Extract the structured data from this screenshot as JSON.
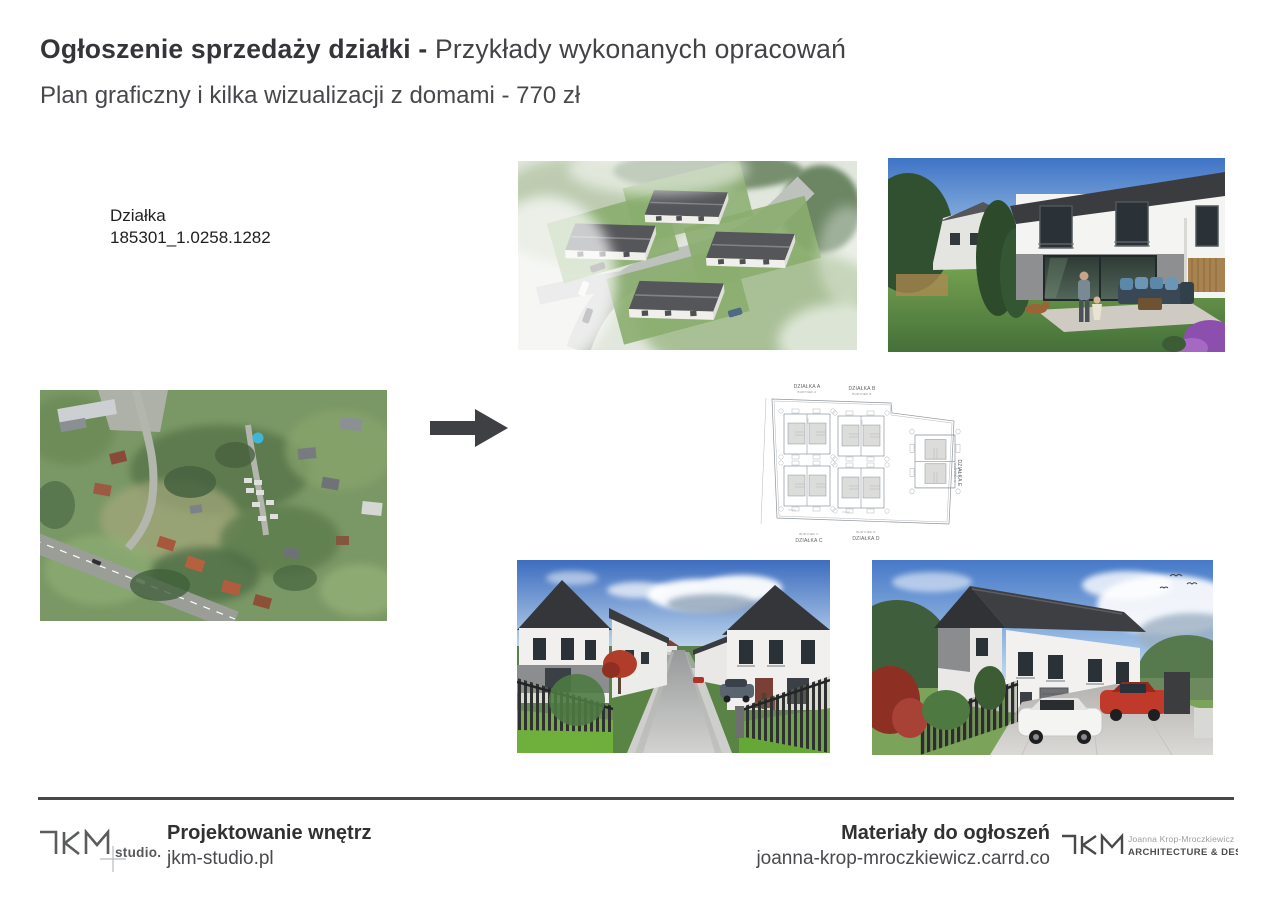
{
  "header": {
    "title_bold": "Ogłoszenie sprzedaży działki -",
    "title_regular": " Przykłady wykonanych opracowań",
    "subtitle": "Plan graficzny i kilka wizualizacji z domami - 770 zł"
  },
  "plot_info": {
    "label": "Działka",
    "id": "185301_1.0258.1282"
  },
  "site_plan": {
    "plots": [
      {
        "name": "DZIAŁKA A",
        "building": "BUDYNEK A"
      },
      {
        "name": "DZIAŁKA B",
        "building": "BUDYNEK B"
      },
      {
        "name": "DZIAŁKA C",
        "building": "BUDYNEK C"
      },
      {
        "name": "DZIAŁKA D",
        "building": "BUDYNEK D"
      },
      {
        "name": "DZIAŁKA E",
        "building": "BUDYNEK E"
      }
    ]
  },
  "footer": {
    "left": {
      "logo_studio": "studio.pl",
      "title": "Projektowanie wnętrz",
      "url": "jkm-studio.pl"
    },
    "right": {
      "title": "Materiały do ogłoszeń",
      "url": "joanna-krop-mroczkiewicz.carrd.co",
      "logo_name": "Joanna Krop-Mroczkiewicz",
      "logo_tagline": "ARCHITECTURE & DESIGN"
    }
  },
  "colors": {
    "text_dark": "#353539",
    "text_gray": "#48484c",
    "arrow": "#3f4043",
    "divider": "#47484a",
    "roof_dark": "#3d3e42",
    "lawn_green": "#6fae3e",
    "sky_blue": "#4679c8"
  }
}
